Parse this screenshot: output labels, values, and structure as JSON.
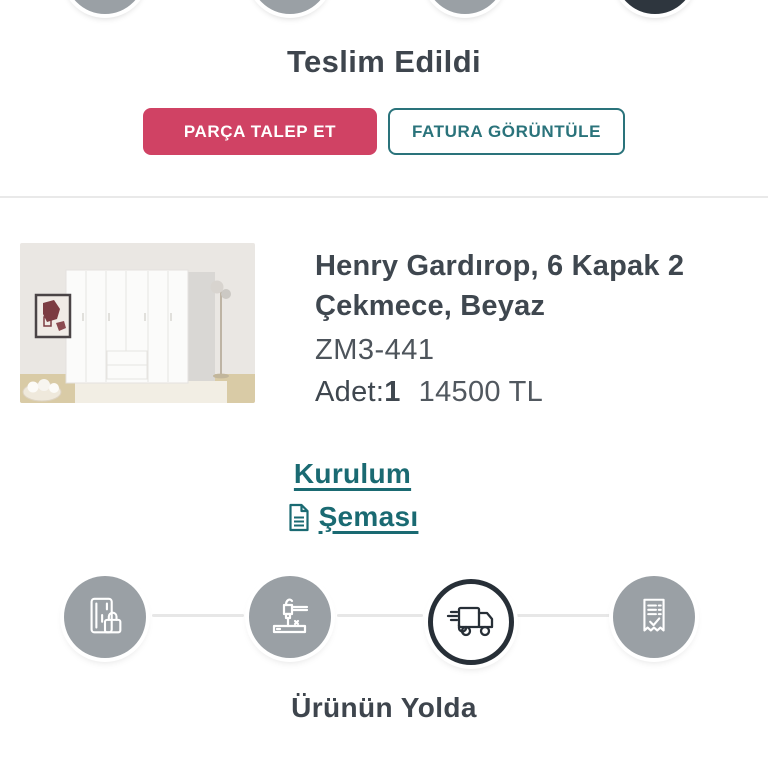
{
  "status": {
    "title": "Teslim Edildi",
    "request_part_label": "PARÇA TALEP ET",
    "view_invoice_label": "FATURA GÖRÜNTÜLE"
  },
  "product": {
    "title": "Henry Gardırop, 6 Kapak 2 Çekmece, Beyaz",
    "sku": "ZM3-441",
    "qty_label": "Adet:",
    "qty_value": "1",
    "price": "14500 TL",
    "scheme_link_line1": "Kurulum",
    "scheme_link_line2": "Şeması"
  },
  "tracker": {
    "current_step_label": "Ürünün Yolda",
    "steps": [
      {
        "icon": "credit-card-lock-icon",
        "state": "done"
      },
      {
        "icon": "assembly-drill-icon",
        "state": "done"
      },
      {
        "icon": "delivery-truck-icon",
        "state": "active"
      },
      {
        "icon": "receipt-check-icon",
        "state": "upcoming"
      }
    ]
  },
  "top_tracker": {
    "steps": [
      {
        "state": "done"
      },
      {
        "state": "done"
      },
      {
        "state": "done"
      },
      {
        "state": "active-dark"
      }
    ]
  },
  "colors": {
    "accent_pink": "#d04264",
    "accent_teal": "#2a737b",
    "link_teal": "#1a6a72",
    "dark_text": "#3e454d",
    "step_gray": "#9aa0a5",
    "step_dark": "#2e363e",
    "divider": "#e9e9e9"
  }
}
